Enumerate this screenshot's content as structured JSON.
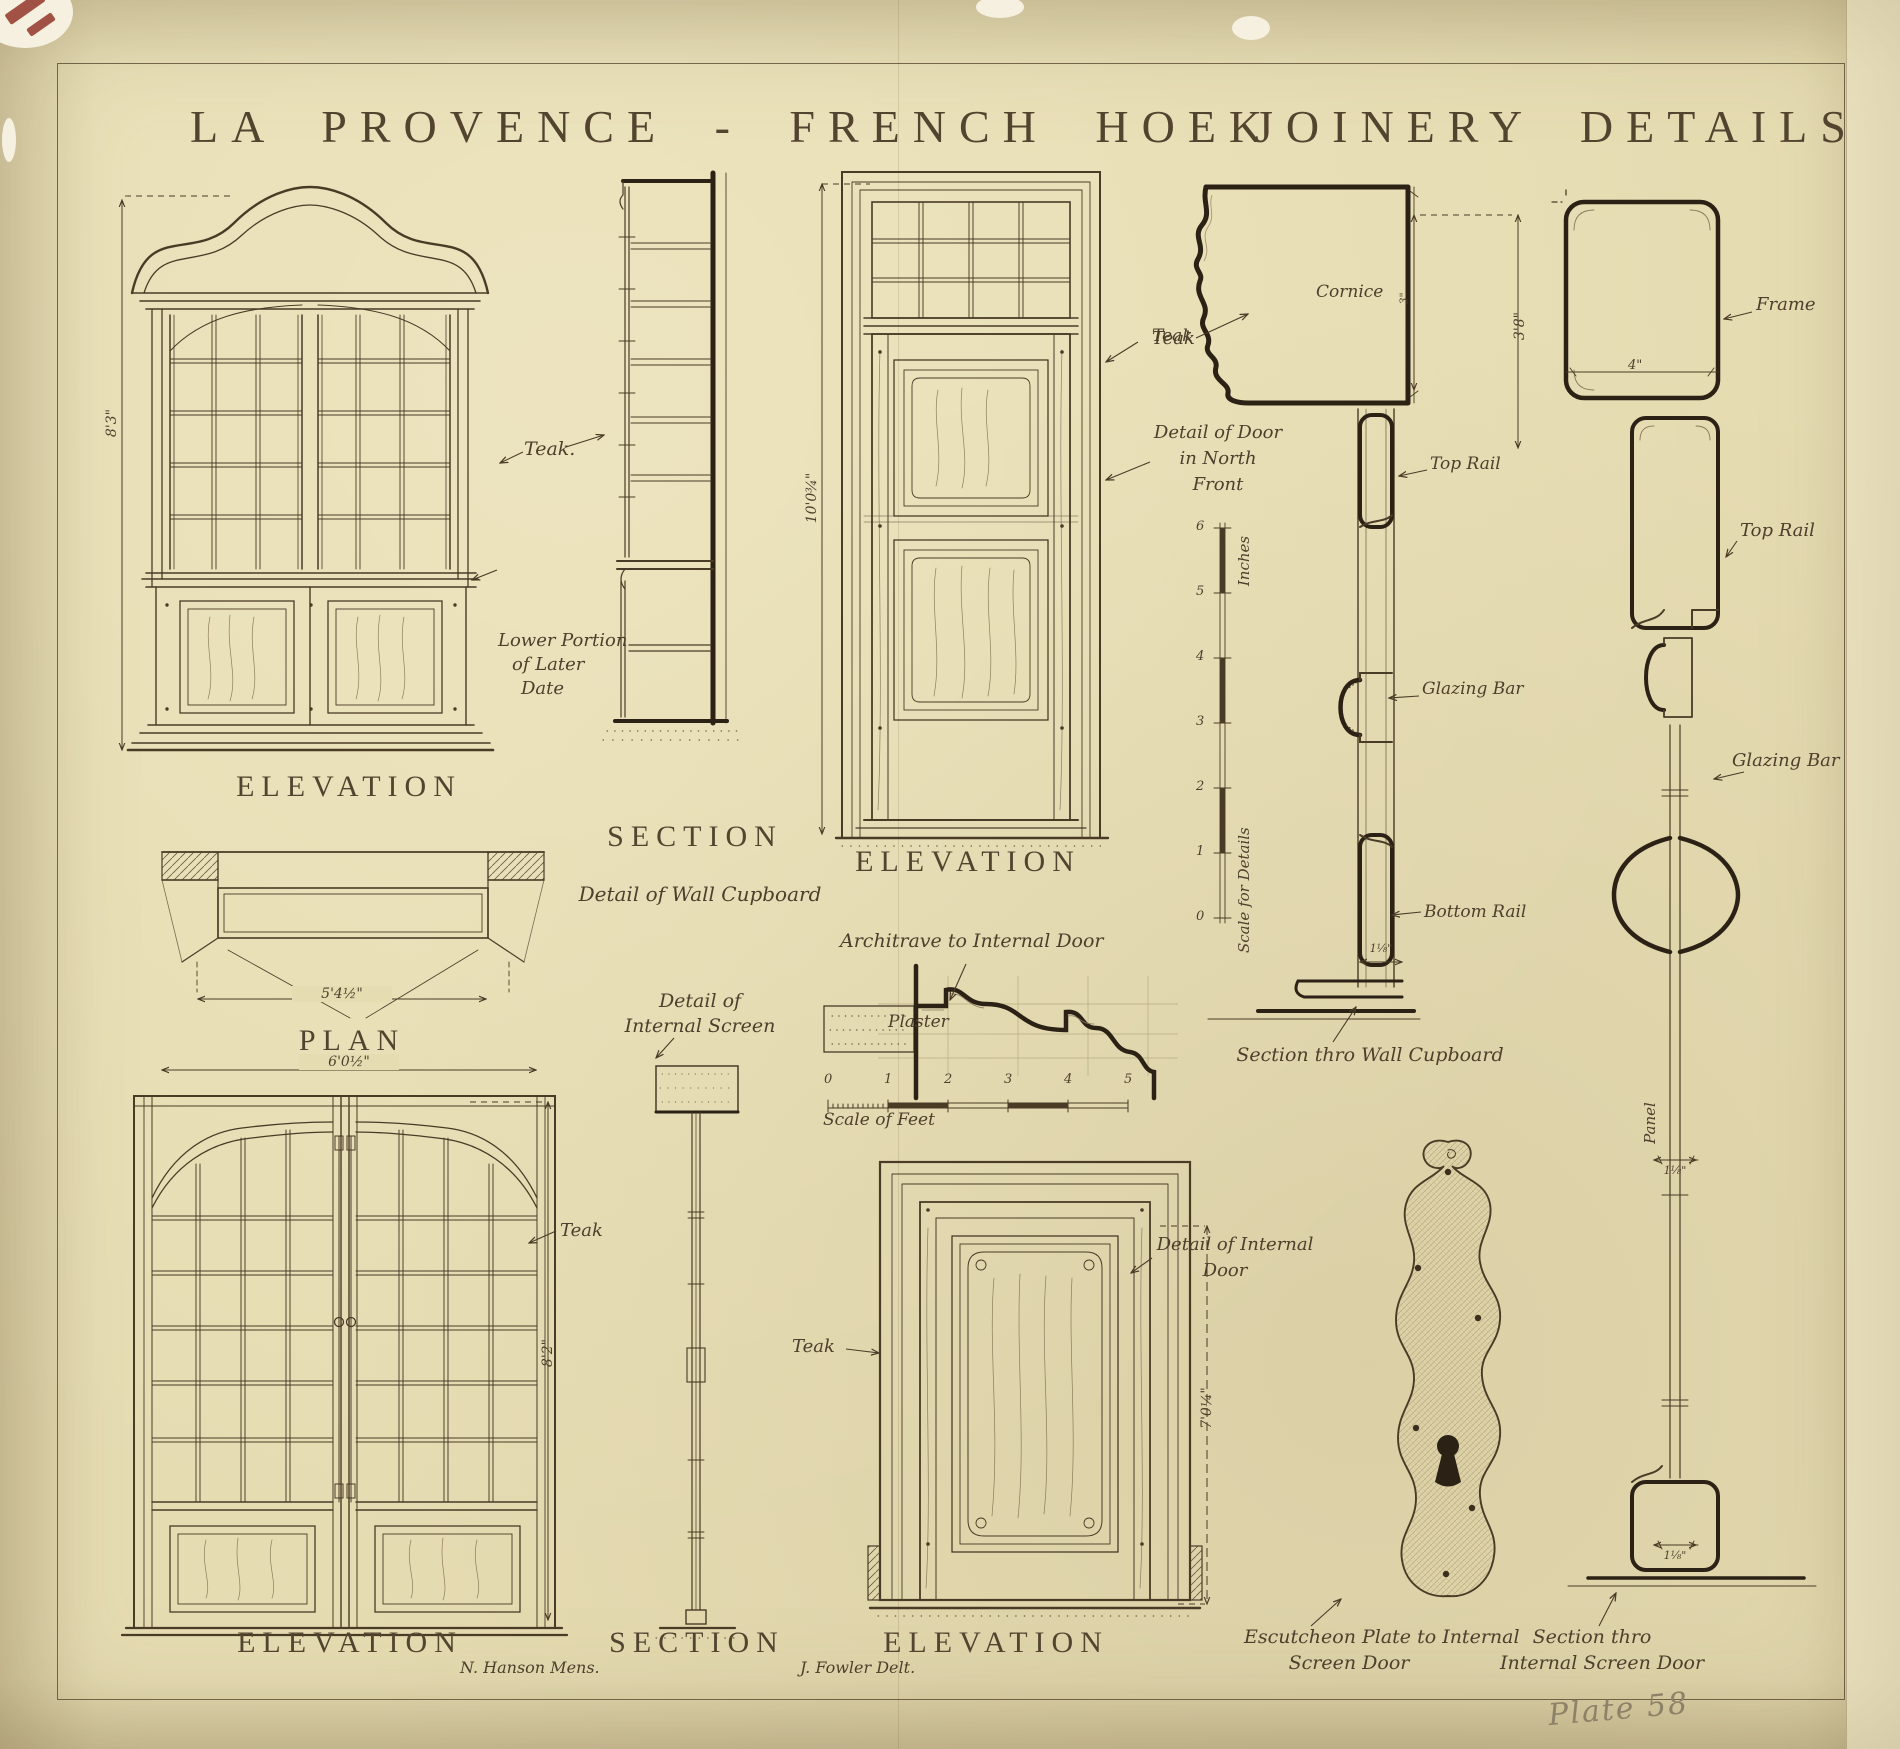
{
  "colors": {
    "paper": "#e6dcb2",
    "ink": "#4a3b26",
    "poche": "#2b2114",
    "pencil": "#8d8168",
    "caption": "#53442f"
  },
  "titles": {
    "left": "LA PROVENCE - FRENCH HOEK",
    "right": "JOINERY DETAILS"
  },
  "cupboard": {
    "teak": "Teak.",
    "lower_note_1": "Lower Portion",
    "lower_note_2": "of Later",
    "lower_note_3": "Date",
    "height_dim": "8'3\"",
    "elevation_caption": "ELEVATION",
    "section_caption": "SECTION",
    "section_sub": "Detail of Wall Cupboard",
    "plan_caption": "PLAN",
    "plan_dim": "5'4½\""
  },
  "north_door": {
    "teak": "Teak",
    "note_1": "Detail of Door",
    "note_2": "in North",
    "note_3": "Front",
    "height_dim": "10'0¾\"",
    "caption": "ELEVATION"
  },
  "screen": {
    "width_dim": "6'0½\"",
    "teak": "Teak",
    "height_dim": "8'2\"",
    "caption": "ELEVATION",
    "section_caption": "SECTION",
    "detail_note_1": "Detail of",
    "detail_note_2": "Internal Screen"
  },
  "architrave": {
    "title": "Architrave to Internal Door",
    "plaster": "Plaster",
    "scale_label": "Scale of Feet",
    "ticks": [
      "0",
      "1",
      "2",
      "3",
      "4",
      "5"
    ]
  },
  "internal_door": {
    "note_1": "Detail of Internal",
    "note_2": "Door",
    "teak": "Teak",
    "height_dim": "7'0¼\"",
    "caption": "ELEVATION"
  },
  "cupboard_section": {
    "cornice": "Cornice",
    "teak": "Teak",
    "top_rail": "Top Rail",
    "glazing_bar": "Glazing Bar",
    "bottom_rail": "Bottom Rail",
    "caption": "Section thro Wall Cupboard",
    "cornice_dim": "3\"",
    "height_dim": "3'8\"",
    "sill_dim": "1⅛\"",
    "scale_title": "Inches",
    "scale_sub": "Scale for Details",
    "ticks": [
      "6",
      "5",
      "4",
      "3",
      "2",
      "1",
      "0"
    ]
  },
  "screen_section": {
    "frame": "Frame",
    "top_rail": "Top Rail",
    "glazing_bar": "Glazing Bar",
    "panel": "Panel",
    "frame_dim": "4\"",
    "panel_dim_top": "1⅛\"",
    "panel_dim_bottom": "1⅛\"",
    "caption_1": "Section thro",
    "caption_2": "Internal Screen Door"
  },
  "escutcheon": {
    "caption_1": "Escutcheon Plate to Internal",
    "caption_2": "Screen Door"
  },
  "credits": {
    "measured": "N. Hanson Mens.",
    "drawn": "J. Fowler Delt.",
    "plate_number": "Plate 58"
  }
}
